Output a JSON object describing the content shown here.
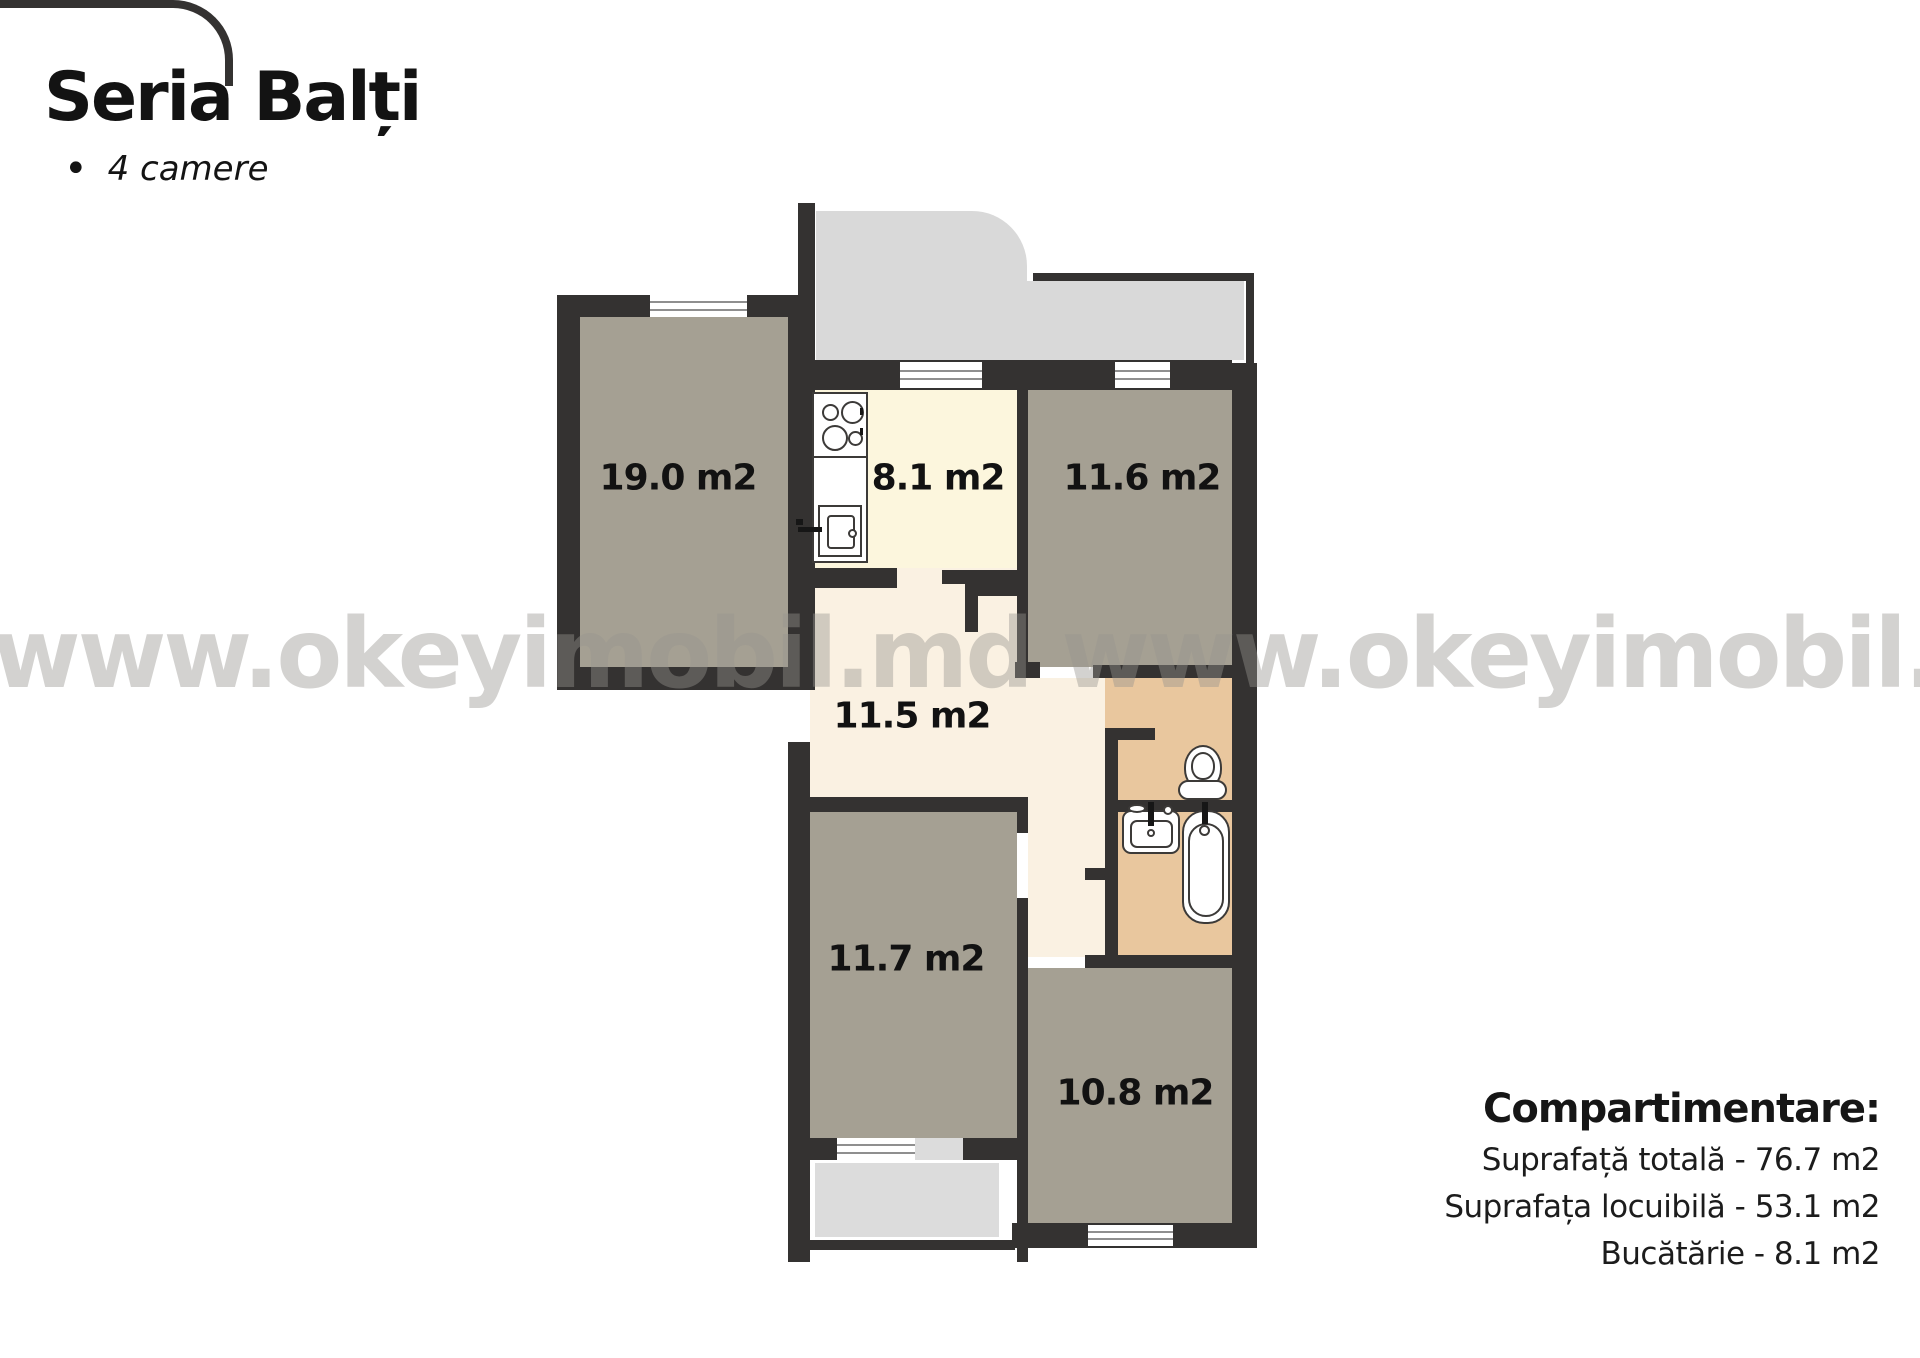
{
  "header": {
    "title": "Seria Balți",
    "bullet": "•",
    "subtitle": "4 camere"
  },
  "watermark": {
    "text": "www.okeyimobil.md www.okeyimobil.md"
  },
  "plan": {
    "rooms": [
      {
        "id": "camera-1",
        "area_label": "19.0 m2"
      },
      {
        "id": "bucatarie",
        "area_label": "8.1 m2"
      },
      {
        "id": "camera-2",
        "area_label": "11.6 m2"
      },
      {
        "id": "hol",
        "area_label": "11.5 m2"
      },
      {
        "id": "camera-3",
        "area_label": "11.7 m2"
      },
      {
        "id": "camera-4",
        "area_label": "10.8 m2"
      }
    ]
  },
  "summary": {
    "heading": "Compartimentare:",
    "lines": [
      "Suprafață totală - 76.7 m2",
      "Suprafața locuibilă - 53.1 m2",
      "Bucătărie - 8.1 m2"
    ]
  },
  "colors": {
    "wall": "#343231",
    "room_fill": "#a5a093",
    "kitchen_fill": "#fcf6dd",
    "hall_fill": "#faf1e2",
    "bathroom_fill": "#e9c79e",
    "balcony_fill": "#d9d9d9",
    "loggia_fill": "#dcdcdc",
    "watermark": "#d3d1cf",
    "text": "#111111"
  }
}
